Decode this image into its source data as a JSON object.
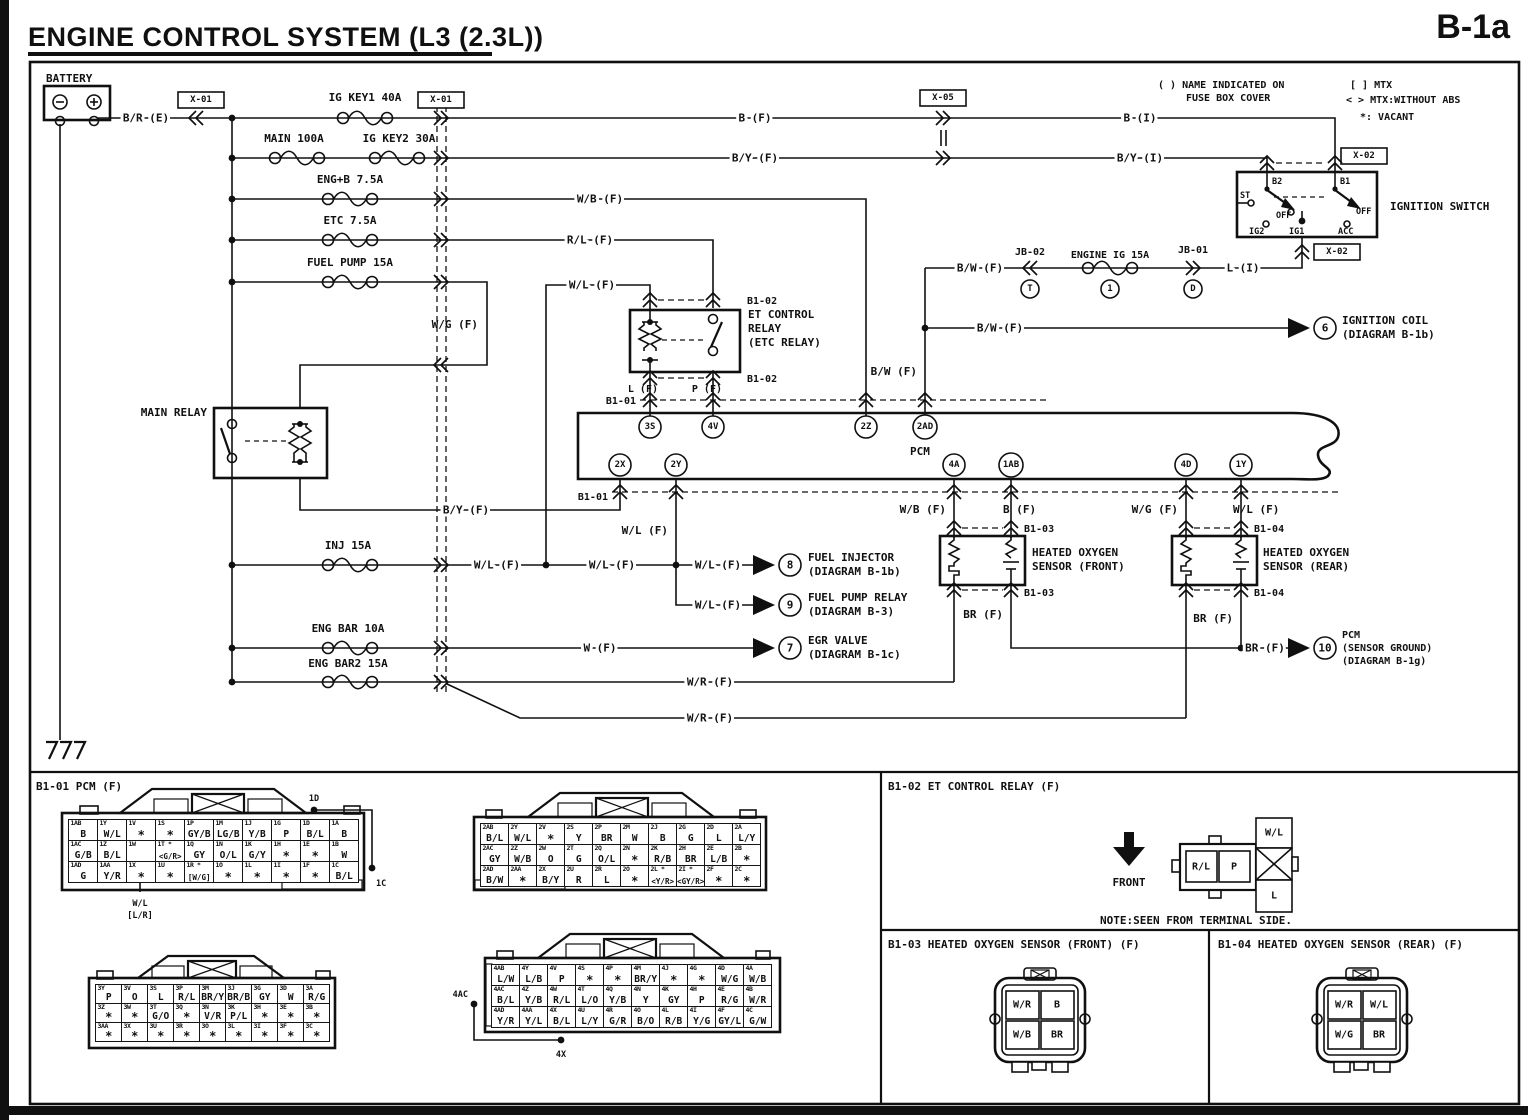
{
  "page": {
    "title": "ENGINE CONTROL SYSTEM (L3 (2.3L))",
    "code": "B-1a"
  },
  "legend": {
    "name_note_1": "( ) NAME INDICATED ON",
    "name_note_2": "FUSE BOX COVER",
    "mtx": "[ ] MTX",
    "mtx_abs": "< > MTX:WITHOUT ABS",
    "vacant": "*: VACANT"
  },
  "battery": {
    "label": "BATTERY",
    "minus": "−",
    "plus": "+"
  },
  "boxes": {
    "x01": "X-01",
    "x02": "X-02",
    "x05": "X-05"
  },
  "junction_blocks": {
    "jb02": "JB-02",
    "jb01": "JB-01",
    "t": "T",
    "one": "1",
    "d": "D"
  },
  "fuses": {
    "ig_key1": "IG KEY1 40A",
    "main": "MAIN 100A",
    "ig_key2": "IG KEY2 30A",
    "eng_b": "ENG+B 7.5A",
    "etc": "ETC 7.5A",
    "fuel_pump": "FUEL PUMP 15A",
    "inj": "INJ 15A",
    "eng_bar": "ENG BAR 10A",
    "eng_bar2": "ENG BAR2 15A",
    "engine_ig": "ENGINE IG 15A"
  },
  "wires": {
    "br_e": "B/R (E)",
    "b_f": "B (F)",
    "b_i": "B (I)",
    "by_f": "B/Y (F)",
    "by_i": "B/Y (I)",
    "wb_f": "W/B (F)",
    "rl_f": "R/L (F)",
    "wl_f": "W/L (F)",
    "wg_f": "W/G (F)",
    "w_f": "W (F)",
    "wr_f": "W/R (F)",
    "bw_f": "B/W (F)",
    "br_f": "BR (F)",
    "l_i": "L (I)",
    "l_f": "L (F)",
    "p_f": "P (F)"
  },
  "components": {
    "main_relay": "MAIN RELAY",
    "et_relay_1": "ET CONTROL",
    "et_relay_2": "RELAY",
    "et_relay_3": "(ETC RELAY)",
    "pcm": "PCM",
    "ignition_switch": "IGNITION SWITCH",
    "hos_front_1": "HEATED OXYGEN",
    "hos_front_2": "SENSOR (FRONT)",
    "hos_rear_1": "HEATED OXYGEN",
    "hos_rear_2": "SENSOR (REAR)"
  },
  "ignition": {
    "b2": "B2",
    "b1": "B1",
    "st": "ST",
    "off": "OFF",
    "ig2": "IG2",
    "ig1": "IG1",
    "acc": "ACC"
  },
  "connector_rows": {
    "b101": "B1-01",
    "b102": "B1-02",
    "b103": "B1-03",
    "b104": "B1-04"
  },
  "pcm_terminals": {
    "t3s": "3S",
    "t4v": "4V",
    "t2z": "2Z",
    "t2ad": "2AD",
    "t2x": "2X",
    "t2y": "2Y",
    "t4a": "4A",
    "t1ab": "1AB",
    "t4d": "4D",
    "t1y": "1Y"
  },
  "refs": {
    "r6": {
      "num": "6",
      "line1": "IGNITION COIL",
      "line2": "(DIAGRAM B-1b)"
    },
    "r7": {
      "num": "7",
      "line1": "EGR VALVE",
      "line2": "(DIAGRAM B-1c)"
    },
    "r8": {
      "num": "8",
      "line1": "FUEL INJECTOR",
      "line2": "(DIAGRAM B-1b)"
    },
    "r9": {
      "num": "9",
      "line1": "FUEL PUMP RELAY",
      "line2": "(DIAGRAM B-3)"
    },
    "r10": {
      "num": "10",
      "line1": "PCM",
      "line2": "(SENSOR GROUND)",
      "line3": "(DIAGRAM B-1g)"
    }
  },
  "panels": {
    "b101": {
      "header": "B1-01 PCM (F)",
      "annotations": {
        "d1": "1D",
        "c1": "1C",
        "ac4": "4AC",
        "x4": "4X",
        "wl": "W/L",
        "lr": "[L/R]"
      },
      "blocks": [
        {
          "rows": [
            [
              {
                "pin": "1AB",
                "val": "B"
              },
              {
                "pin": "1Y",
                "val": "W/L"
              },
              {
                "pin": "1V",
                "val": "*"
              },
              {
                "pin": "1S",
                "val": "*"
              },
              {
                "pin": "1P",
                "val": "GY/B"
              },
              {
                "pin": "1M",
                "val": "LG/B"
              },
              {
                "pin": "1J",
                "val": "Y/B"
              },
              {
                "pin": "1G",
                "val": "P"
              },
              {
                "pin": "1D",
                "val": "B/L"
              },
              {
                "pin": "1A",
                "val": "B"
              }
            ],
            [
              {
                "pin": "1AC",
                "val": "G/B"
              },
              {
                "pin": "1Z",
                "val": "B/L"
              },
              {
                "pin": "1W",
                "val": ""
              },
              {
                "pin": "1T *",
                "val": "<G/R>"
              },
              {
                "pin": "1Q",
                "val": "GY"
              },
              {
                "pin": "1N",
                "val": "O/L"
              },
              {
                "pin": "1K",
                "val": "G/Y"
              },
              {
                "pin": "1H",
                "val": "*"
              },
              {
                "pin": "1E",
                "val": "*"
              },
              {
                "pin": "1B",
                "val": "W"
              }
            ],
            [
              {
                "pin": "1AD",
                "val": "G"
              },
              {
                "pin": "1AA",
                "val": "Y/R"
              },
              {
                "pin": "1X",
                "val": "*"
              },
              {
                "pin": "1U",
                "val": "*"
              },
              {
                "pin": "1R *",
                "val": "[W/G]"
              },
              {
                "pin": "1O",
                "val": "*"
              },
              {
                "pin": "1L",
                "val": "*"
              },
              {
                "pin": "1I",
                "val": "*"
              },
              {
                "pin": "1F",
                "val": "*"
              },
              {
                "pin": "1C",
                "val": "B/L"
              }
            ]
          ]
        },
        {
          "rows": [
            [
              {
                "pin": "2AB",
                "val": "B/L"
              },
              {
                "pin": "2Y",
                "val": "W/L"
              },
              {
                "pin": "2V",
                "val": "*"
              },
              {
                "pin": "2S",
                "val": "Y"
              },
              {
                "pin": "2P",
                "val": "BR"
              },
              {
                "pin": "2M",
                "val": "W"
              },
              {
                "pin": "2J",
                "val": "B"
              },
              {
                "pin": "2G",
                "val": "G"
              },
              {
                "pin": "2D",
                "val": "L"
              },
              {
                "pin": "2A",
                "val": "L/Y"
              }
            ],
            [
              {
                "pin": "2AC",
                "val": "GY"
              },
              {
                "pin": "2Z",
                "val": "W/B"
              },
              {
                "pin": "2W",
                "val": "O"
              },
              {
                "pin": "2T",
                "val": "G"
              },
              {
                "pin": "2Q",
                "val": "O/L"
              },
              {
                "pin": "2N",
                "val": "*"
              },
              {
                "pin": "2K",
                "val": "R/B"
              },
              {
                "pin": "2H",
                "val": "BR"
              },
              {
                "pin": "2E",
                "val": "L/B"
              },
              {
                "pin": "2B",
                "val": "*"
              }
            ],
            [
              {
                "pin": "2AD",
                "val": "B/W"
              },
              {
                "pin": "2AA",
                "val": "*"
              },
              {
                "pin": "2X",
                "val": "B/Y"
              },
              {
                "pin": "2U",
                "val": "R"
              },
              {
                "pin": "2R",
                "val": "L"
              },
              {
                "pin": "2O",
                "val": "*"
              },
              {
                "pin": "2L *",
                "val": "<Y/R>"
              },
              {
                "pin": "2I *",
                "val": "<GY/R>"
              },
              {
                "pin": "2F",
                "val": "*"
              },
              {
                "pin": "2C",
                "val": "*"
              }
            ]
          ]
        },
        {
          "rows": [
            [
              {
                "pin": "3Y",
                "val": "P"
              },
              {
                "pin": "3V",
                "val": "O"
              },
              {
                "pin": "3S",
                "val": "L"
              },
              {
                "pin": "3P",
                "val": "R/L"
              },
              {
                "pin": "3M",
                "val": "BR/Y"
              },
              {
                "pin": "3J",
                "val": "BR/B"
              },
              {
                "pin": "3G",
                "val": "GY"
              },
              {
                "pin": "3D",
                "val": "W"
              },
              {
                "pin": "3A",
                "val": "R/G"
              }
            ],
            [
              {
                "pin": "3Z",
                "val": "*"
              },
              {
                "pin": "3W",
                "val": "*"
              },
              {
                "pin": "3T",
                "val": "G/O"
              },
              {
                "pin": "3Q",
                "val": "*"
              },
              {
                "pin": "3N",
                "val": "V/R"
              },
              {
                "pin": "3K",
                "val": "P/L"
              },
              {
                "pin": "3H",
                "val": "*"
              },
              {
                "pin": "3E",
                "val": "*"
              },
              {
                "pin": "3B",
                "val": "*"
              }
            ],
            [
              {
                "pin": "3AA",
                "val": "*"
              },
              {
                "pin": "3X",
                "val": "*"
              },
              {
                "pin": "3U",
                "val": "*"
              },
              {
                "pin": "3R",
                "val": "*"
              },
              {
                "pin": "3O",
                "val": "*"
              },
              {
                "pin": "3L",
                "val": "*"
              },
              {
                "pin": "3I",
                "val": "*"
              },
              {
                "pin": "3F",
                "val": "*"
              },
              {
                "pin": "3C",
                "val": "*"
              }
            ]
          ]
        },
        {
          "rows": [
            [
              {
                "pin": "4AB",
                "val": "L/W"
              },
              {
                "pin": "4Y",
                "val": "L/B"
              },
              {
                "pin": "4V",
                "val": "P"
              },
              {
                "pin": "4S",
                "val": "*"
              },
              {
                "pin": "4P",
                "val": "*"
              },
              {
                "pin": "4M",
                "val": "BR/Y"
              },
              {
                "pin": "4J",
                "val": "*"
              },
              {
                "pin": "4G",
                "val": "*"
              },
              {
                "pin": "4D",
                "val": "W/G"
              },
              {
                "pin": "4A",
                "val": "W/B"
              }
            ],
            [
              {
                "pin": "4AC",
                "val": "B/L"
              },
              {
                "pin": "4Z",
                "val": "Y/B"
              },
              {
                "pin": "4W",
                "val": "R/L"
              },
              {
                "pin": "4T",
                "val": "L/O"
              },
              {
                "pin": "4Q",
                "val": "Y/B"
              },
              {
                "pin": "4N",
                "val": "Y"
              },
              {
                "pin": "4K",
                "val": "GY"
              },
              {
                "pin": "4H",
                "val": "P"
              },
              {
                "pin": "4E",
                "val": "R/G"
              },
              {
                "pin": "4B",
                "val": "W/R"
              }
            ],
            [
              {
                "pin": "4AD",
                "val": "Y/R"
              },
              {
                "pin": "4AA",
                "val": "Y/L"
              },
              {
                "pin": "4X",
                "val": "B/L"
              },
              {
                "pin": "4U",
                "val": "L/Y"
              },
              {
                "pin": "4R",
                "val": "G/R"
              },
              {
                "pin": "4O",
                "val": "B/O"
              },
              {
                "pin": "4L",
                "val": "R/B"
              },
              {
                "pin": "4I",
                "val": "Y/G"
              },
              {
                "pin": "4F",
                "val": "GY/L"
              },
              {
                "pin": "4C",
                "val": "G/W"
              }
            ]
          ]
        }
      ]
    },
    "b102": {
      "header": "B1-02 ET CONTROL RELAY (F)",
      "front": "FRONT",
      "note": "NOTE:SEEN FROM TERMINAL SIDE.",
      "cells": {
        "rl": "R/L",
        "p": "P",
        "wl": "W/L",
        "l": "L"
      }
    },
    "b103": {
      "header": "B1-03 HEATED OXYGEN SENSOR (FRONT) (F)",
      "cells": [
        "W/R",
        "B",
        "W/B",
        "BR"
      ]
    },
    "b104": {
      "header": "B1-04 HEATED OXYGEN SENSOR (REAR) (F)",
      "cells": [
        "W/R",
        "W/L",
        "W/G",
        "BR"
      ]
    }
  }
}
